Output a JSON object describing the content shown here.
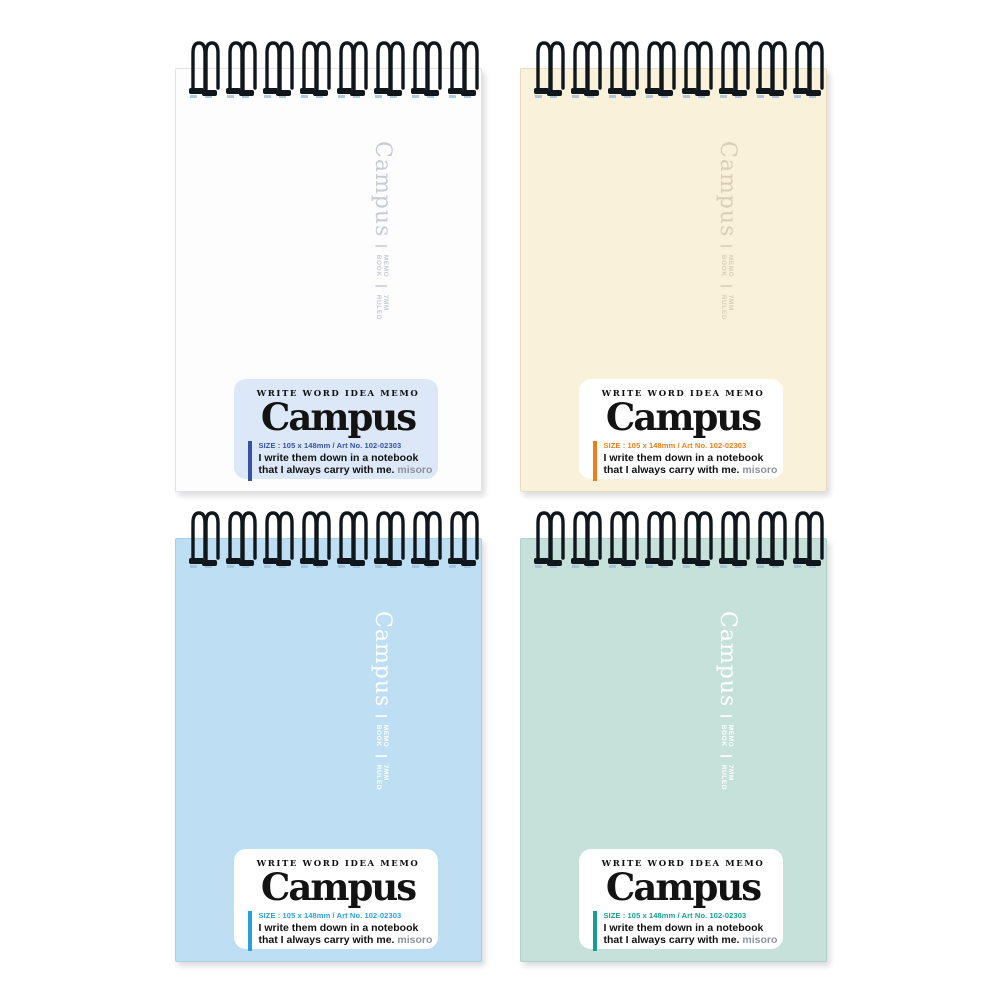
{
  "page": {
    "background": "#ffffff",
    "description_name": "campus-twin-ring-memo-notebooks-grid"
  },
  "shared": {
    "side_text": {
      "brand": "Campus",
      "pipe": "|",
      "group1_top": "MEMO",
      "group1_bottom": "BOOK",
      "group2_top": "7MM",
      "group2_bottom": "RULED"
    },
    "label": {
      "tagline": "WRITE WORD IDEA MEMO",
      "logo": "Campus",
      "size_line": "SIZE : 105 x 148mm / Art No. 102-02303",
      "desc_line1": "I write them down in a notebook",
      "desc_line2": "that I always carry with me.",
      "signature": "misoro"
    }
  },
  "notebooks": [
    {
      "id": "white",
      "cover_color": "#fdfdfe",
      "accent_color": "#3552a5",
      "label_bg": "#dce8f7",
      "side_text_color": "#c7cbd4",
      "style": "--cover:#fdfdfe;--cover-border:#e3e3e7;--side:#c7cbd4;--label-bg:#dce8f7;--accent:#3552a5"
    },
    {
      "id": "cream",
      "cover_color": "#faf1da",
      "accent_color": "#ef7d1a",
      "label_bg": "#ffffff",
      "side_text_color": "#d9cfb6",
      "style": "--cover:#faf1da;--cover-border:#e8ddc2;--side:#d9cfb6;--label-bg:#ffffff;--accent:#ef7d1a"
    },
    {
      "id": "blue",
      "cover_color": "#bedff3",
      "accent_color": "#2b9fdc",
      "label_bg": "#ffffff",
      "side_text_color": "#ffffff",
      "style": "--cover:#bedff3;--cover-border:#a8cfe9;--side:#ffffff;--label-bg:#ffffff;--accent:#2b9fdc"
    },
    {
      "id": "mint",
      "cover_color": "#c6e1da",
      "accent_color": "#169f90",
      "label_bg": "#ffffff",
      "side_text_color": "#ffffff",
      "style": "--cover:#c6e1da;--cover-border:#afd1c9;--side:#ffffff;--label-bg:#ffffff;--accent:#169f90"
    }
  ]
}
